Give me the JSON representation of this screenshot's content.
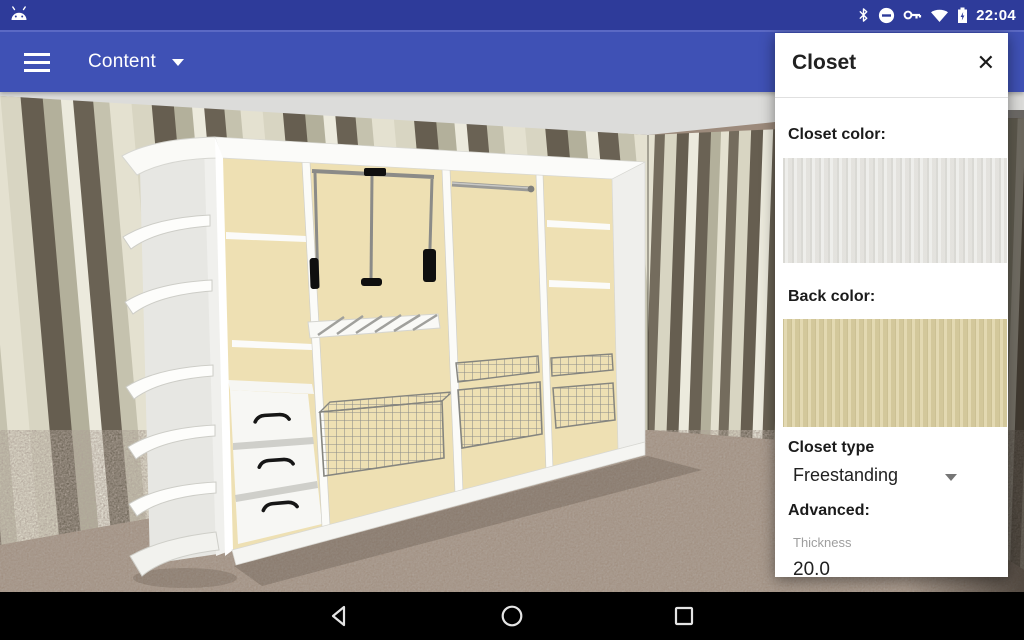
{
  "status_bar": {
    "bg": "#2e3b9a",
    "time": "22:04",
    "icons": [
      "android-head",
      "bluetooth",
      "do-not-disturb",
      "vpn-key",
      "wifi",
      "battery-charging"
    ]
  },
  "toolbar": {
    "bg": "#3f51b5",
    "menu_label": "Content"
  },
  "scene": {
    "colors": {
      "ceiling": "#dcdcda",
      "floor": "#a08e7f",
      "stripe_dark": "#665e50",
      "stripe_dark2": "#6a6254",
      "stripe_sage": "#b3b09b",
      "stripe_cream": "#d8d5c2",
      "stripe_white": "#eceadd",
      "closet_back": "#eee0b3"
    }
  },
  "panel": {
    "title": "Closet",
    "close_glyph": "✕",
    "closet_color_label": "Closet color:",
    "back_color_label": "Back color:",
    "closet_type_label": "Closet type",
    "closet_type_value": "Freestanding",
    "advanced_label": "Advanced:",
    "thickness_label": "Thickness",
    "thickness_value": "20.0",
    "swatch_closet_color": "#e9e8e4",
    "swatch_back_color": "#ddd2a6"
  },
  "navbar": {
    "bg": "#000000",
    "icons": [
      "back",
      "home",
      "recents"
    ]
  }
}
